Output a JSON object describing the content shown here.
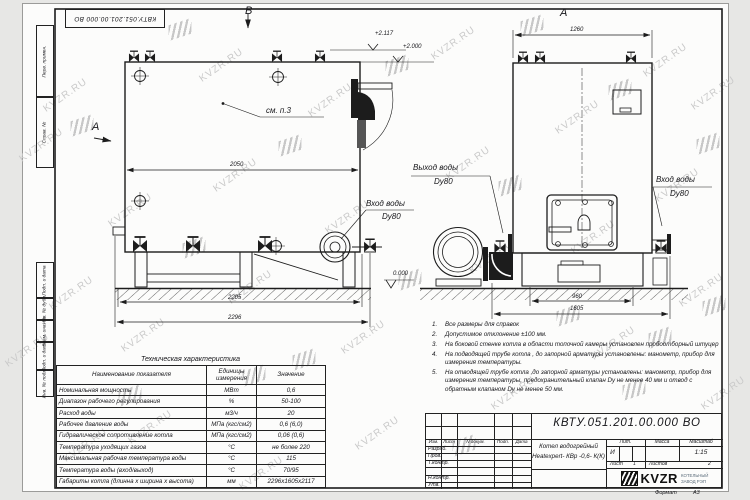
{
  "watermark": {
    "text": "KVZR.RU"
  },
  "stamp_top": "КВТУ.051.201.00.000 ВО",
  "side_column": {
    "labels": [
      "Перв. примен.",
      "Справ. №",
      "Подп. и дата",
      "Инв. № дубл.",
      "Взам. инв. №",
      "Подп. и дата",
      "Инв. № подл."
    ]
  },
  "views": {
    "view_b_label": "В",
    "section_a_label": "А",
    "view_a_label": "А",
    "see_note": "см. п.3",
    "left": {
      "dim_2050": "2050",
      "dim_2205": "2205",
      "dim_2296": "2296",
      "elev_2117": "+2.117",
      "elev_2000": "+2.000",
      "elev_0": "0.000",
      "inlet_label": "Вход воды",
      "inlet_dn": "Dy80"
    },
    "right": {
      "dim_1260": "1260",
      "dim_960": "960",
      "dim_1605": "1605",
      "outlet_label": "Выход воды",
      "outlet_dn": "Dy80",
      "inlet_label": "Вход воды",
      "inlet_dn": "Dy80"
    }
  },
  "tech_table": {
    "title": "Техническая характеристика",
    "headers": [
      "Наименование показателя",
      "Единицы измерения",
      "Значение"
    ],
    "rows": [
      [
        "Номинальная мощность",
        "МВт",
        "0,6"
      ],
      [
        "Диапазон рабочего регулирования",
        "%",
        "50-100"
      ],
      [
        "Расход воды",
        "м3/ч",
        "20"
      ],
      [
        "Рабочее давление воды",
        "МПа (кгс/см2)",
        "0,6 (6,0)"
      ],
      [
        "Гидравлическое сопротивление котла",
        "МПа (кгс/см2)",
        "0,06 (0,6)"
      ],
      [
        "Температура уходящих газов",
        "°С",
        "не более 220"
      ],
      [
        "Максимальная рабочая температура воды",
        "°С",
        "115"
      ],
      [
        "Температура воды (вход/выход)",
        "°С",
        "70/95"
      ],
      [
        "Габариты котла (длинна х ширина х высота)",
        "мм",
        "2296х1605х2117"
      ]
    ]
  },
  "notes": {
    "items": [
      {
        "num": "1.",
        "text": "Все размеры для справок"
      },
      {
        "num": "2.",
        "text": "Допустимое отклонение  ±100 мм."
      },
      {
        "num": "3.",
        "text": "На боковой стенке котла в области топочной камеры установлен пробоотборный штуцер"
      },
      {
        "num": "4.",
        "text": "На  подводящей трубе котла , до запорной арматуры установлены: манометр, прибор для измерения температуры."
      },
      {
        "num": "5.",
        "text": "На отводящей трубе котла ,до запорной арматуры установлены: манометр, прибор для измерения температуры, предохранительный клапан Dу не менее 40 мм и отвод с обратным клапаном Dу не менее 50 мм."
      }
    ]
  },
  "title_block": {
    "doc_number": "КВТУ.051.201.00.000 ВО",
    "product_name_line1": "Котел водогрейный",
    "product_name_line2": "Heatexpert- КВр -0,6- К(К)",
    "col_headers": [
      "Изм.",
      "Лист",
      "N докум.",
      "Подп.",
      "Дата"
    ],
    "row_labels": [
      "Разраб.",
      "Пров.",
      "Т.контр.",
      "Н.контр.",
      "Утв."
    ],
    "lit_header": "Лит.",
    "mass_header": "Масса",
    "scale_header": "Масштаб",
    "lit_value": "И",
    "scale_value": "1:15",
    "sheet_label": "Лист",
    "sheet_value": "1",
    "sheets_label": "Листов",
    "sheets_value": "2",
    "company_logo": "KVZR",
    "company_name_line1": "КОТЕЛЬНЫЙ",
    "company_name_line2": "ЗАВОД РЭП",
    "format_label": "Формат",
    "format_value": "А3"
  },
  "colors": {
    "line": "#1c1c1c",
    "watermark": "#cacaca",
    "sheet": "#fcfcfb"
  }
}
